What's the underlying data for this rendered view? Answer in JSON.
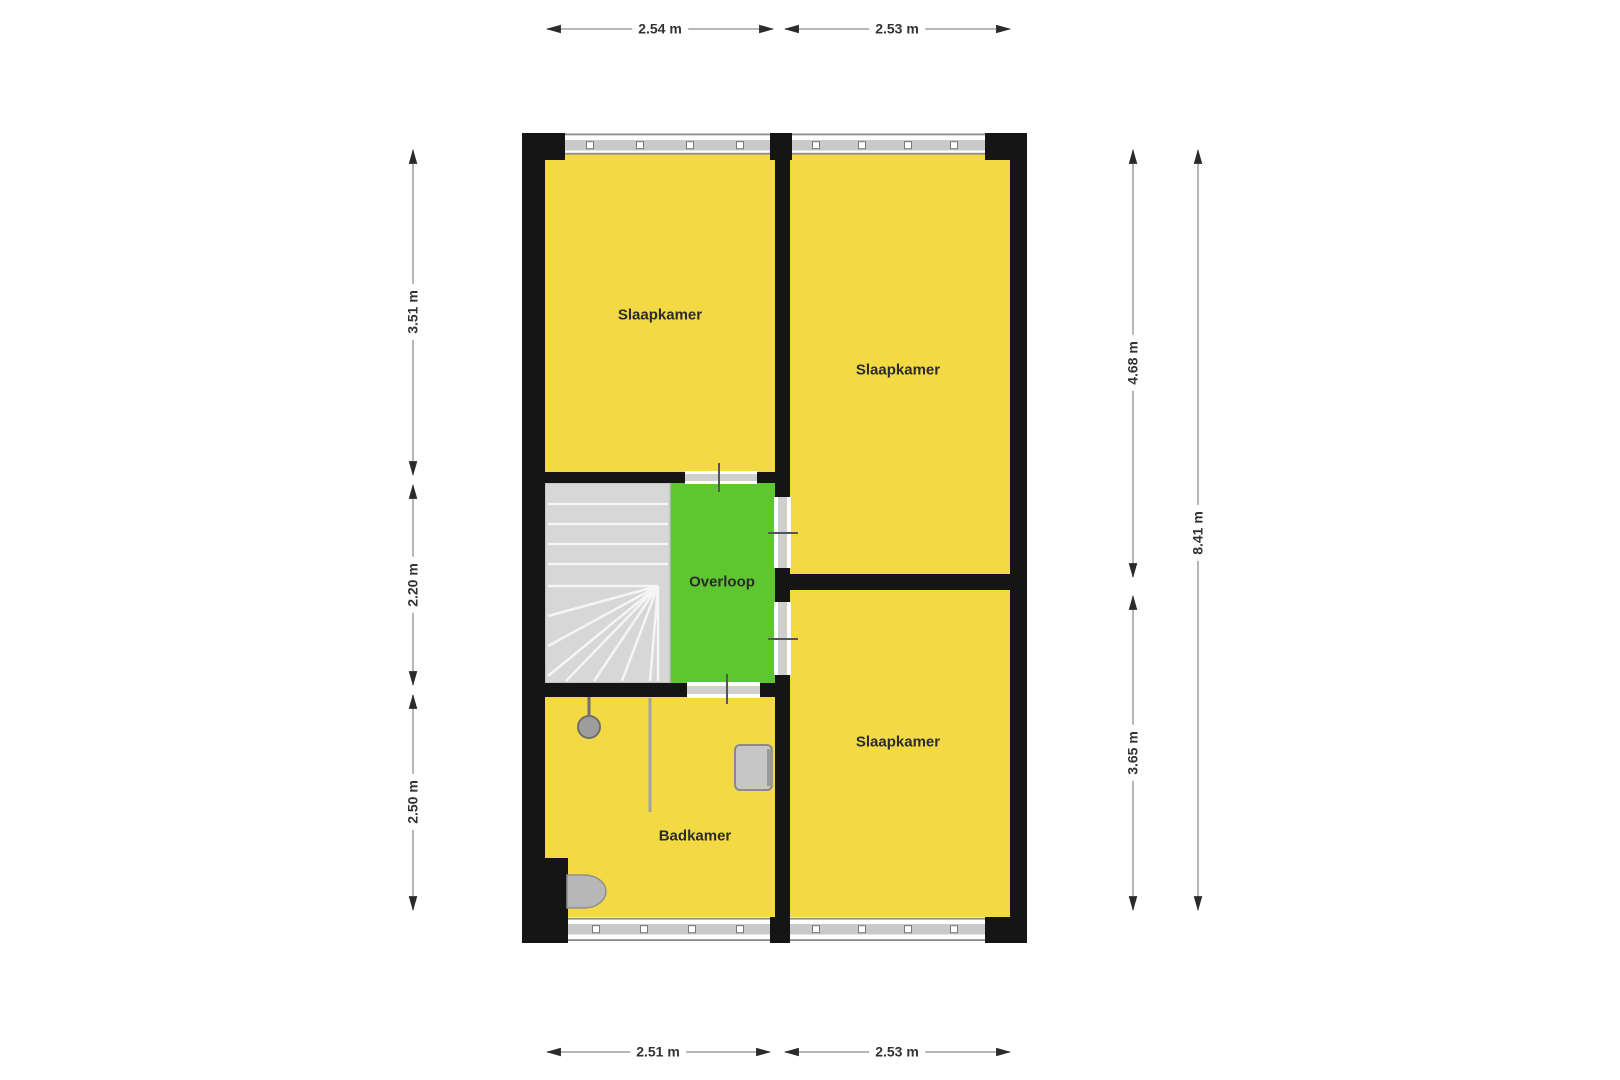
{
  "rooms": [
    {
      "label": "Slaapkamer"
    },
    {
      "label": "Slaapkamer"
    },
    {
      "label": "Slaapkamer"
    },
    {
      "label": "Overloop"
    },
    {
      "label": "Badkamer"
    }
  ],
  "dimensions": {
    "top": [
      "2.54 m",
      "2.53 m"
    ],
    "bottom": [
      "2.51 m",
      "2.53 m"
    ],
    "left": [
      "3.51 m",
      "2.20 m",
      "2.50 m"
    ],
    "right_inner": [
      "4.68 m",
      "3.65 m"
    ],
    "right_outer": [
      "8.41 m"
    ]
  },
  "fixtures": [
    "stairs-winder",
    "shower",
    "shower-partition",
    "sink",
    "toilet"
  ],
  "colors": {
    "room_fill": "#f3da45",
    "hall_fill": "#5ec62f",
    "wall": "#151515",
    "stairs_fill": "#d7d7d7",
    "window_bar": "#c9c9c9",
    "door_bar": "#cfcfcf",
    "fixture_gray": "#9d9d9d",
    "dimension_line": "#9d9d9d",
    "text": "#2b2b2b",
    "background": "#ffffff"
  }
}
